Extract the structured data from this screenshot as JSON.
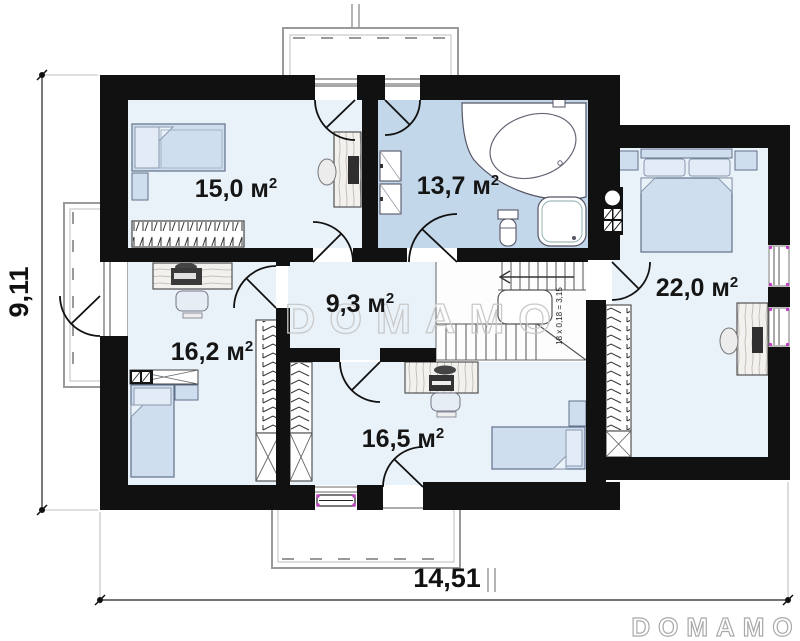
{
  "rooms": [
    {
      "id": "room-top-left",
      "area": "15,0 м",
      "sup": "2"
    },
    {
      "id": "bathroom",
      "area": "13,7 м",
      "sup": "2"
    },
    {
      "id": "room-right",
      "area": "22,0 м",
      "sup": "2"
    },
    {
      "id": "hall",
      "area": "9,3 м",
      "sup": "2"
    },
    {
      "id": "room-mid-left",
      "area": "16,2 м",
      "sup": "2"
    },
    {
      "id": "room-bottom",
      "area": "16,5 м",
      "sup": "2"
    }
  ],
  "stairs": {
    "note": "18 x 0,18 = 3,15"
  },
  "dimensions": {
    "width": "14,51",
    "height": "9,11"
  },
  "watermark": "DOMAMO",
  "brand": "DOMAMO",
  "colors": {
    "wall": "#111111",
    "floor": "#eaf2f9",
    "bathroom_floor": "#c3d7ea",
    "furniture_blue": "#cfdeee",
    "accent_magenta": "#c93ec9",
    "outline_gray": "#999999"
  }
}
